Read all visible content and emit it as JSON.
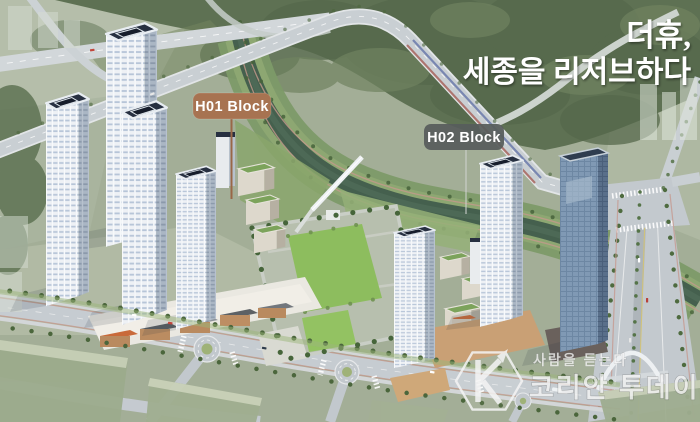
{
  "overlay_labels": {
    "h01": "H01 Block",
    "h02": "H02 Block"
  },
  "headline": {
    "line1": "더휴,",
    "line2": "세종을 리저브하다"
  },
  "watermark": {
    "icon": "hexagon-k-logo",
    "tagline": "사람을 듣는다",
    "name": "코리안 투데이"
  },
  "colors": {
    "h01_badge": "#a77351",
    "h02_badge": "#575d5b",
    "headline_text": "#ffffff",
    "label_text": "#ffffff",
    "water": "#45604e",
    "lawn": "#8dbd5e",
    "forest": "#5e7153",
    "tower_roof": "#273041",
    "glass_tower": "#8099b4",
    "retail_brick": "#b98a5f",
    "road": "#c6ccd1"
  }
}
